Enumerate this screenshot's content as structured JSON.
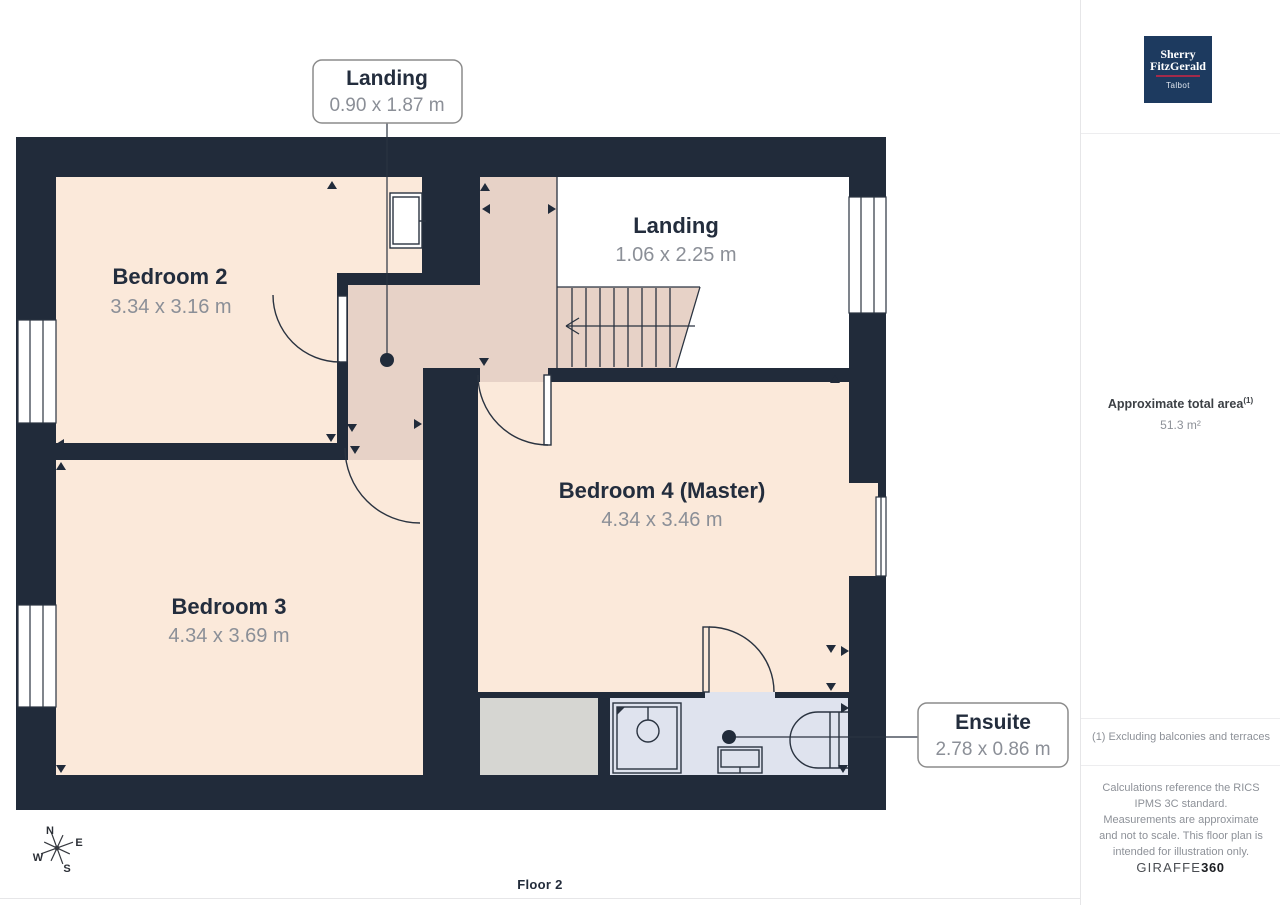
{
  "plan": {
    "floor_label": "Floor 2",
    "rooms": [
      {
        "name": "Bedroom 2",
        "dims": "3.34 x 3.16 m"
      },
      {
        "name": "Bedroom 3",
        "dims": "4.34 x 3.69 m"
      },
      {
        "name": "Bedroom 4 (Master)",
        "dims": "4.34 x 3.46 m"
      },
      {
        "name": "Landing",
        "dims": "1.06 x 2.25 m"
      }
    ],
    "callouts": [
      {
        "label": "Landing",
        "dims": "0.90 x 1.87 m"
      },
      {
        "label": "Ensuite",
        "dims": "2.78 x 0.86 m"
      }
    ],
    "compass": {
      "n": "N",
      "e": "E",
      "s": "S",
      "w": "W"
    },
    "colors": {
      "wall": "#212b3a",
      "room_fill": "#fbe9da",
      "hall_fill": "#e7d2c7",
      "ensuite_fill": "#dfe3ee",
      "storage_fill": "#d6d6d2",
      "landing_fill": "#ffffff"
    }
  },
  "sidebar": {
    "logo": {
      "line1": "Sherry",
      "line2": "FitzGerald",
      "subtitle": "Talbot",
      "bg_color": "#1d3a5f",
      "accent_color": "#a32a4a"
    },
    "area_label": "Approximate total area",
    "area_footnote_marker": "(1)",
    "area_value": "51.3 m²",
    "footnote": "(1) Excluding balconies and terraces",
    "disclaimer": "Calculations reference the RICS IPMS 3C standard. Measurements are approximate and not to scale. This floor plan is intended for illustration only.",
    "brand": {
      "name": "GIRAFFE",
      "suffix": "360"
    }
  }
}
